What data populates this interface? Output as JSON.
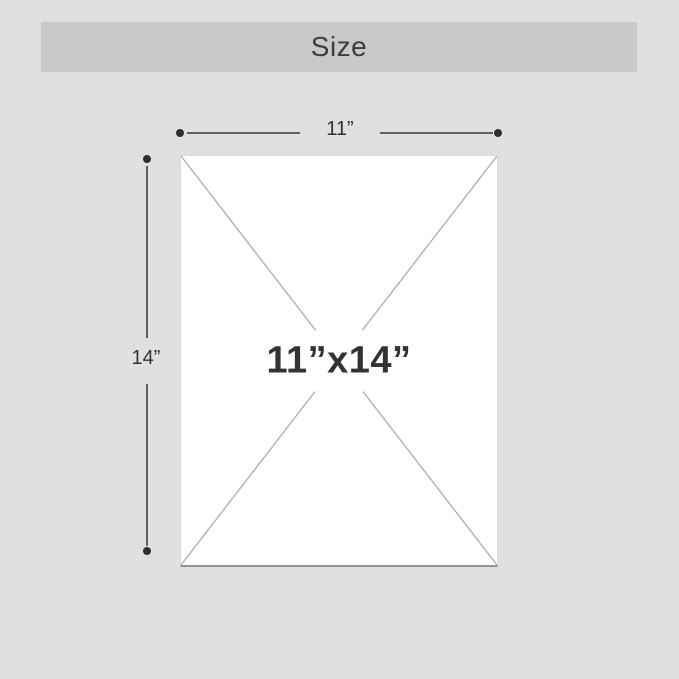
{
  "colors": {
    "page-bg": "#e0e0e0",
    "bar-bg": "#c9c9c9",
    "panel-bg": "#ffffff",
    "title-color": "#3d3d3d",
    "label-color": "#333333",
    "dim-line": "#606060",
    "dot": "#2f2f2f",
    "diagonal": "#ababab",
    "panel-border": "#d9d9d9",
    "panel-bottom": "#939393"
  },
  "header": {
    "title": "Size"
  },
  "dimensions": {
    "width": {
      "label": "11”"
    },
    "height": {
      "label": "14”"
    },
    "center": {
      "label": "11”x14”"
    }
  }
}
